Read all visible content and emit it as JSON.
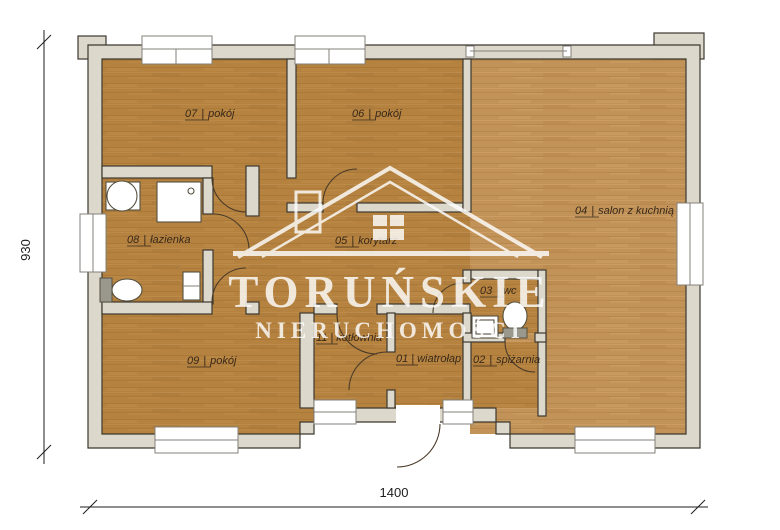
{
  "watermark": {
    "title": "TORUŃSKIE",
    "subtitle": "NIERUCHOMOŚCI",
    "logo": "house-outline-icon",
    "color": "#ffffff"
  },
  "label_separator": "|",
  "dimensions": {
    "width_label": "1400",
    "height_label": "930"
  },
  "rooms": [
    {
      "id": "07",
      "name": "pokój"
    },
    {
      "id": "06",
      "name": "pokój"
    },
    {
      "id": "04",
      "name": "salon z kuchnią"
    },
    {
      "id": "08",
      "name": "łazienka"
    },
    {
      "id": "05",
      "name": "korytarz"
    },
    {
      "id": "03",
      "name": "wc"
    },
    {
      "id": "09",
      "name": "pokój"
    },
    {
      "id": "11",
      "name": "kotłownia"
    },
    {
      "id": "01",
      "name": "wiatrołap"
    },
    {
      "id": "02",
      "name": "spiżarnia"
    }
  ],
  "colors": {
    "floor_dark": "#b5823f",
    "floor_light": "#c29358",
    "wall_fill": "#dcd8cb",
    "outline": "#3c382f",
    "watermark": "#ffffff"
  }
}
